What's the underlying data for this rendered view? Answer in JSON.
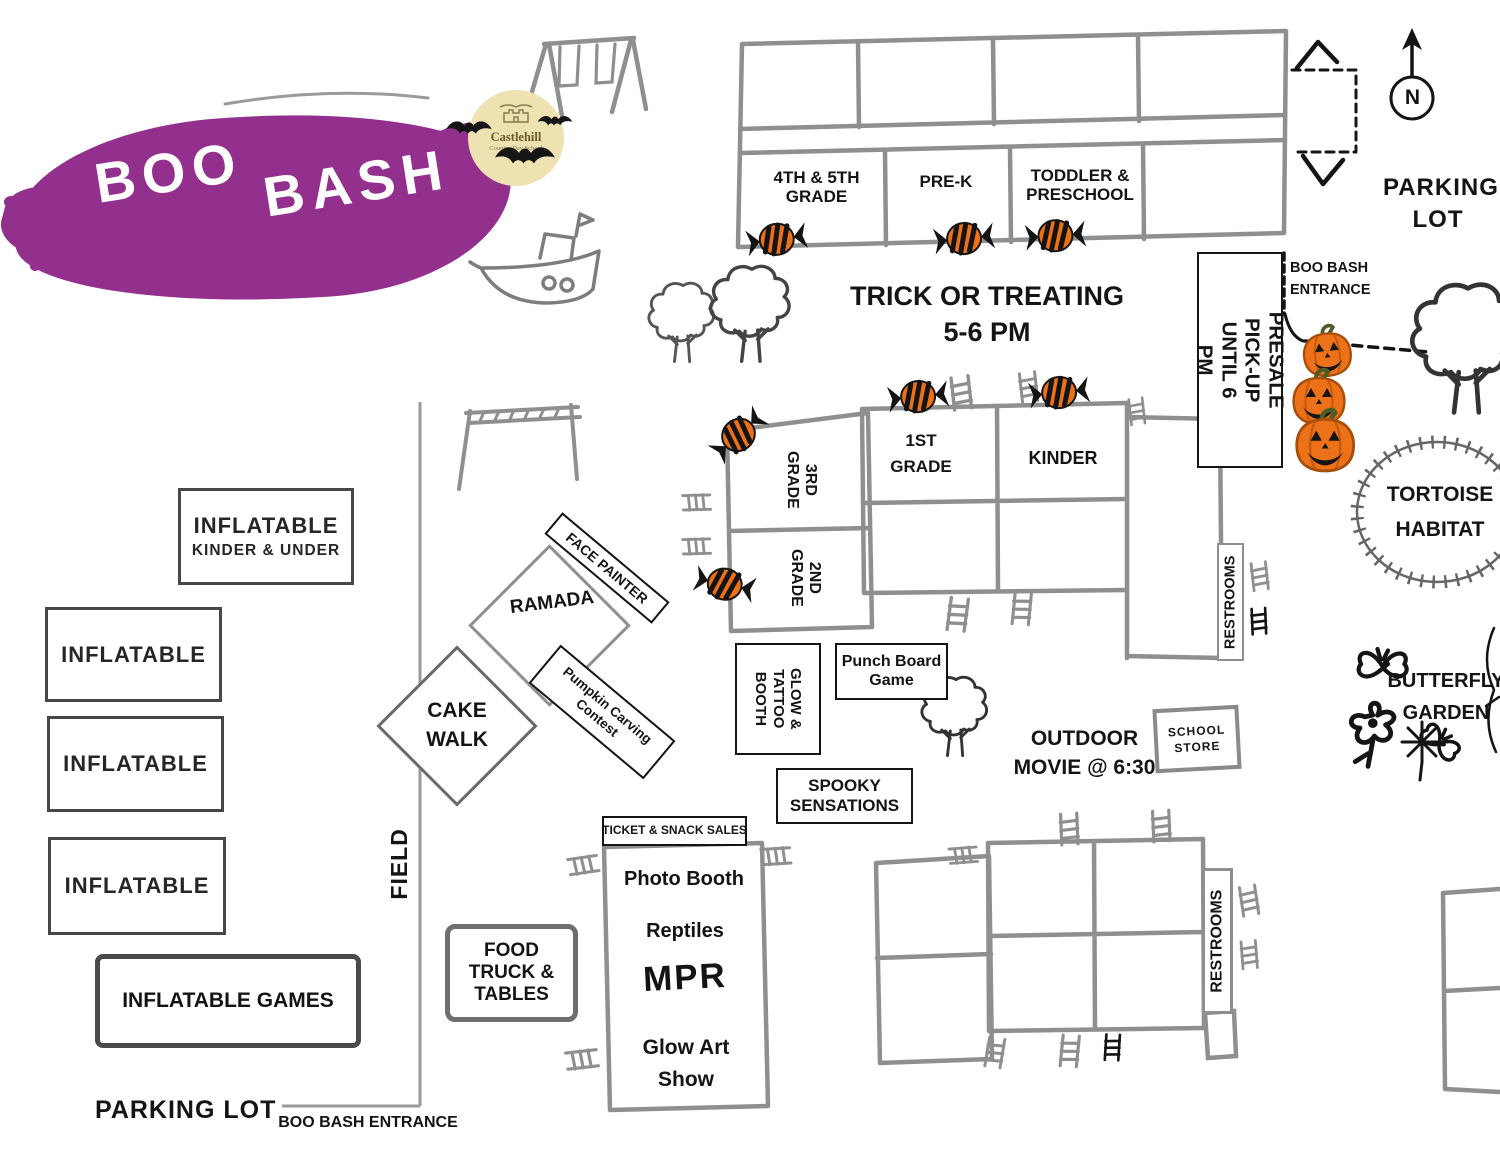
{
  "colors": {
    "brand_purple": "#93308e",
    "candy_orange": "#ed7117",
    "pumpkin_orange": "#ec7118",
    "moon_yellow": "#efe2b2",
    "sketch_gray": "#8f8f8f",
    "ink": "#141414"
  },
  "logo": {
    "title_word1": "BOO",
    "title_word2": "BASH",
    "school_name": "Castlehill",
    "school_subtitle": "Country Day School"
  },
  "compass": {
    "north": "N"
  },
  "northeast": {
    "parking_line1": "PARKING",
    "parking_line2": "LOT",
    "entrance_line1": "BOO BASH",
    "entrance_line2": "ENTRANCE"
  },
  "top_building": {
    "room1": "4TH & 5TH GRADE",
    "room2": "PRE-K",
    "room3": "TODDLER & PRESCHOOL"
  },
  "trick_or_treat": {
    "line1": "TRICK OR TREATING",
    "line2": "5-6 PM"
  },
  "presale": {
    "line1": "PRESALE PICK-UP",
    "line2": "UNTIL 6 PM"
  },
  "nature": {
    "tortoise_line1": "TORTOISE",
    "tortoise_line2": "HABITAT",
    "butterfly_line1": "BUTTERFLY",
    "butterfly_line2": "GARDEN"
  },
  "middle_building": {
    "grade1": "1ST GRADE",
    "kinder": "KINDER",
    "grade3": "3RD GRADE",
    "grade2": "2ND GRADE",
    "restrooms": "RESTROOMS"
  },
  "activities": {
    "face_painter": "FACE PAINTER",
    "ramada": "RAMADA",
    "pumpkin_carving": "Pumpkin Carving Contest",
    "cake_walk": "CAKE WALK",
    "glow_tattoo": "GLOW & TATTOO BOOTH",
    "punch_board": "Punch Board Game",
    "spooky": "SPOOKY SENSATIONS",
    "movie_line1": "OUTDOOR",
    "movie_line2": "MOVIE @ 6:30",
    "school_store": "SCHOOL STORE"
  },
  "field_side": {
    "field": "FIELD",
    "inflatable_kinder_line1": "INFLATABLE",
    "inflatable_kinder_line2": "KINDER & UNDER",
    "inflatables": [
      "INFLATABLE",
      "INFLATABLE",
      "INFLATABLE"
    ],
    "inflatable_games": "INFLATABLE GAMES",
    "parking_lot": "PARKING LOT",
    "entrance": "BOO BASH ENTRANCE"
  },
  "mpr": {
    "header": "TICKET & SNACK SALES",
    "item_photo": "Photo Booth",
    "item_reptiles": "Reptiles",
    "item_mpr": "MPR",
    "item_glow": "Glow Art Show",
    "food_truck": "FOOD TRUCK & TABLES"
  },
  "south_building": {
    "restrooms": "RESTROOMS"
  },
  "icons": {
    "candy": "striped-candy-icon",
    "pumpkins": "jack-o-lantern-stack-icon",
    "bat": "bat-icon",
    "moon": "full-moon-icon",
    "tree": "tree-icon",
    "swing": "swing-set-icon",
    "boat": "boat-icon",
    "monkey_bars": "monkey-bars-icon",
    "steps": "steps-icon",
    "compass": "north-compass-icon",
    "butterfly": "butterfly-icon",
    "flower": "flower-icon"
  }
}
